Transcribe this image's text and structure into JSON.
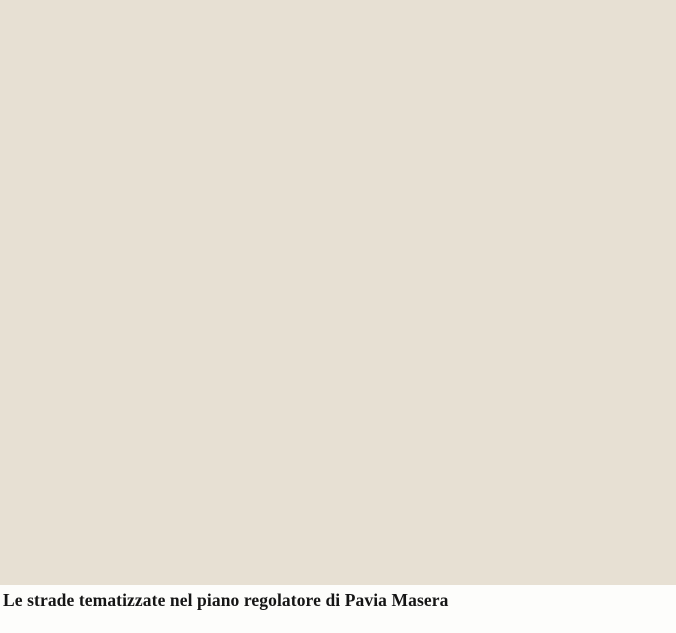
{
  "figure": {
    "caption": "Le strade tematizzate nel piano regolatore di Pavia Masera"
  },
  "map": {
    "alt": "Historic plan of Milan: the thematised street network traced in red over a parchment base map, with parks in green, expansion zones shaded pink and the dense urban core in grey",
    "colors": {
      "page_bg": "#fdfdfb",
      "parchment": "#e7e0d3",
      "parchment_light": "#ece7db",
      "basemap_line": "#a29d92",
      "basemap_line_dark": "#8d887d",
      "pink_zone": "#eec5b4",
      "urban_gray": "#9b968c",
      "urban_gray_light": "#c8c3b8",
      "park_green": "#93c05a",
      "park_green_dark": "#6f9a40",
      "road_red": "#c3170b",
      "bright_red": "#e80400",
      "road_fill": "#f2e9d8",
      "caption_text": "#151515"
    }
  }
}
